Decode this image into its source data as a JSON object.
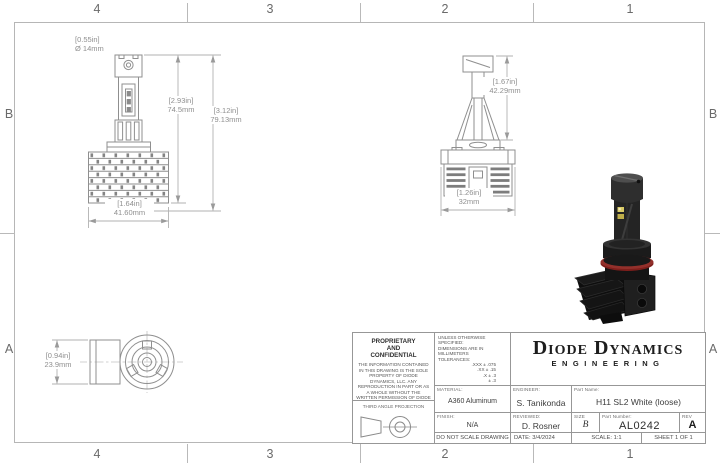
{
  "sheet": {
    "zones_top": [
      "4",
      "3",
      "2",
      "1"
    ],
    "zones_bottom": [
      "4",
      "3",
      "2",
      "1"
    ],
    "zones_left": [
      "B",
      "A"
    ],
    "zones_right": [
      "B",
      "A"
    ]
  },
  "dimensions": {
    "front_dia_in": "[0.55in]",
    "front_dia_mm": "Ø 14mm",
    "front_h1_in": "[2.93in]",
    "front_h1_mm": "74.5mm",
    "front_h2_in": "[3.12in]",
    "front_h2_mm": "79.13mm",
    "front_w_in": "[1.64in]",
    "front_w_mm": "41.60mm",
    "side_h_in": "[1.67in]",
    "side_h_mm": "42.29mm",
    "side_w_in": "[1.26in]",
    "side_w_mm": "32mm",
    "base_dia_in": "[0.94in]",
    "base_dia_mm": "23.9mm"
  },
  "title_block": {
    "proprietary_heading": "PROPRIETARY\nAND\nCONFIDENTIAL",
    "proprietary_body": "THE INFORMATION CONTAINED IN THIS DRAWING IS THE SOLE PROPERTY OF DIODE DYNAMICS, LLC. ANY REPRODUCTION IN PART OR AS A WHOLE WITHOUT THE WRITTEN PERMISSION OF DIODE DYNAMICS, LLC. IS PROHIBITED.",
    "projection_label": "THIRD ANGLE PROJECTION",
    "spec_line1": "UNLESS OTHERWISE SPECIFIED:",
    "spec_line2": "DIMENSIONS ARE IN MILLIMETERS",
    "tolerances_label": "TOLERANCES:",
    "tolerances": [
      ".XXX ± .075",
      ".XX ± .15",
      ".X ± .3",
      "± .3",
      "ANG ± 1"
    ],
    "material_label": "MATERIAL:",
    "material_value": "A360 Aluminum",
    "finish_label": "FINISH:",
    "finish_value": "N/A",
    "engineer_label": "ENGINEER:",
    "engineer_value": "S. Tanikonda",
    "reviewed_label": "REVIEWED:",
    "reviewed_value": "D. Rosner",
    "logo_line1": "Diode Dynamics",
    "logo_line2": "ENGINEERING",
    "part_name_label": "Part Name:",
    "part_name_value": "H11 SL2 White (loose)",
    "size_label": "SIZE",
    "size_value": "B",
    "part_number_label": "Part Number:",
    "part_number_value": "AL0242",
    "rev_label": "REV",
    "rev_value": "A",
    "do_not_scale": "DO NOT SCALE DRAWING",
    "date_label": "DATE:",
    "date_value": "3/4/2024",
    "scale_text": "SCALE: 1:1",
    "sheet_text": "SHEET 1 OF 1"
  },
  "colors": {
    "line_gray": "#8f8f8f",
    "dim_gray": "#b2b2b2",
    "ink": "#1d1d1d",
    "oring_red": "#7e1e1b"
  }
}
